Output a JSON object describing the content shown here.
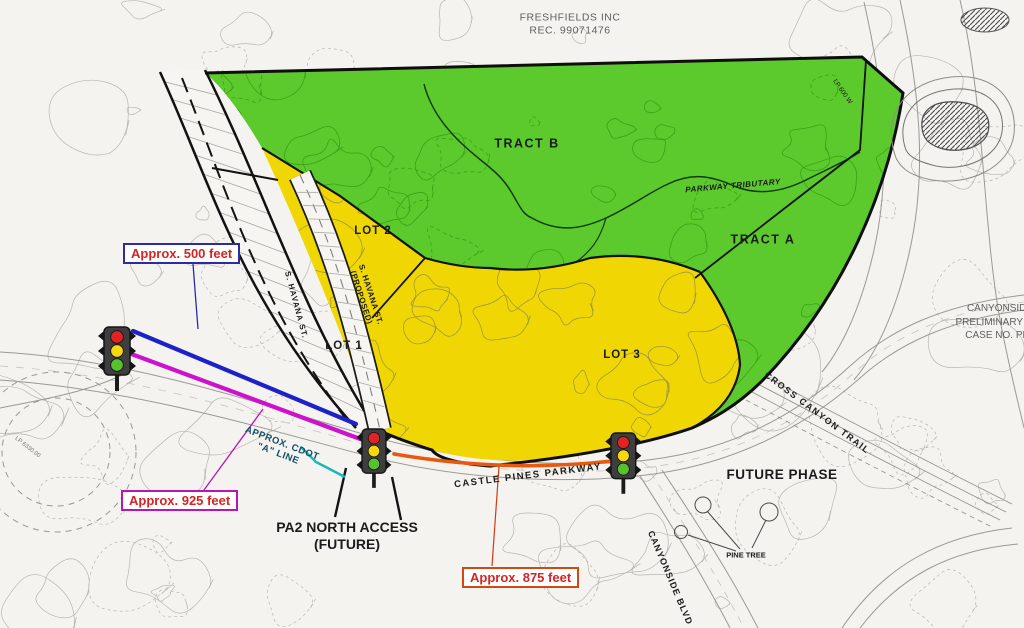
{
  "header": {
    "line1": "FRESHFIELDS INC",
    "line2": "REC. 99071476"
  },
  "parcels": {
    "tract_b": "TRACT B",
    "tract_a": "TRACT A",
    "lot1": "LOT 1",
    "lot2": "LOT 2",
    "lot3": "LOT 3",
    "future_phase": "FUTURE PHASE"
  },
  "roads": {
    "castle_pines_parkway": "CASTLE PINES PARKWAY",
    "s_havana_st": "S. HAVANA ST.",
    "s_havana_proposed_line1": "S. HAVANA ST.",
    "s_havana_proposed_line2": "(PROPOSED)",
    "cross_canyon_trail": "CROSS CANYON TRAIL",
    "canyonside_blvd": "CANYONSIDE BLVD"
  },
  "water": {
    "tributary": "PARKWAY TRIBUTARY"
  },
  "measurements": {
    "north": {
      "label": "Approx. 500 feet",
      "line_color": "#1c22c8"
    },
    "west": {
      "label": "Approx. 925 feet",
      "line_color": "#cc12cc"
    },
    "south": {
      "label": "Approx. 875 feet",
      "line_color": "#e8590e"
    }
  },
  "annotations": {
    "cdot1": "APPROX. CDOT",
    "cdot2": "\"A\" LINE",
    "pa2_1": "PA2 NORTH ACCESS",
    "pa2_2": "(FUTURE)",
    "pine_tree": "PINE TREE",
    "lp_station": "LP 6330.00",
    "lp_edge": "LP 600 W"
  },
  "case_note": {
    "line1": "CANYONSIDE",
    "line2": "PRELIMINARY PLA",
    "line3": "CASE NO. PP2"
  },
  "colors": {
    "tract_fill": "#5cc92c",
    "lot_fill": "#f0d703",
    "measure_text": "#d32525",
    "cdot_text": "#134f63",
    "signal_red": "#e32222",
    "signal_yellow": "#f6d80c",
    "signal_green": "#57c12f"
  }
}
